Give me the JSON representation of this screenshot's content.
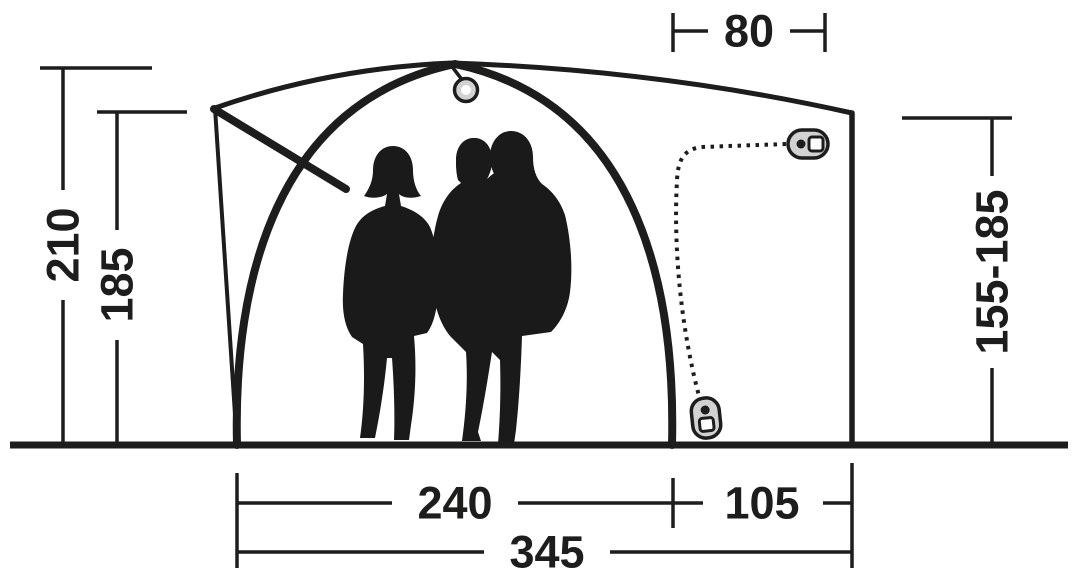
{
  "diagram": {
    "background_color": "#ffffff",
    "line_color": "#1d1d1b",
    "hardware_fill_color": "#d2d2d2",
    "dimensions": {
      "top_width": "80",
      "peak_height": "210",
      "front_corner_height": "185",
      "side_height_range": "155-185",
      "main_section_width": "240",
      "extension_width": "105",
      "total_width": "345"
    },
    "icons": {
      "hanging_loop": "hanging-loop-icon",
      "zipper_pull_top": "zipper-pull-icon",
      "zipper_pull_bottom": "zipper-pull-icon"
    }
  }
}
